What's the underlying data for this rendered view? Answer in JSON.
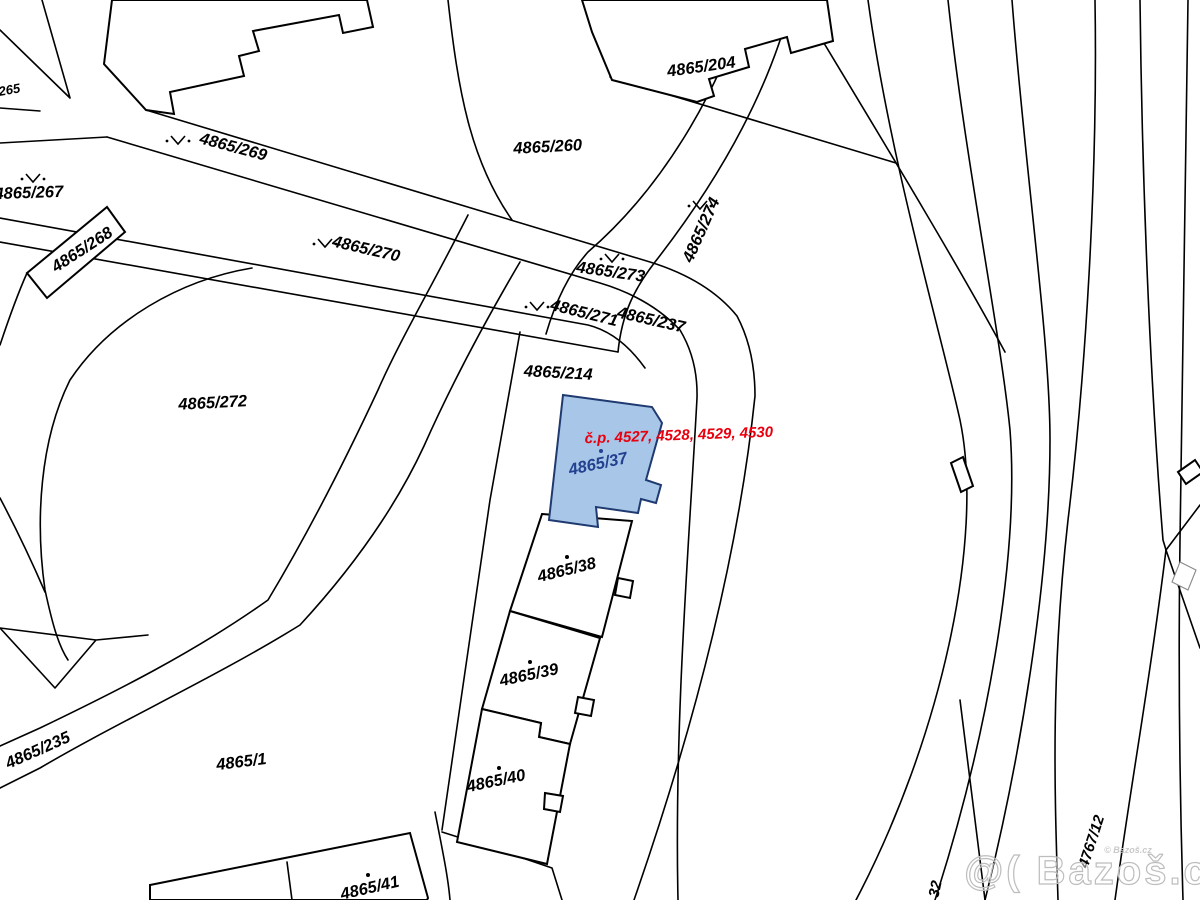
{
  "map": {
    "title": "cadastral-map-detail",
    "background_color": "#ffffff",
    "line_color": "#000000",
    "highlight": {
      "parcel": "4865/37",
      "fill": "#a7c6e8",
      "stroke": "#1f3a70",
      "label_color": "#23418f",
      "house_numbers_label": "č.p. 4527, 4528, 4529, 4530",
      "house_numbers_color": "#e8000f"
    },
    "watermark": {
      "text": "@( Bazoš.cz",
      "small_text": "© Bazoš.cz",
      "color": "#bdbdbd"
    },
    "labels": [
      {
        "text": "4865/265",
        "x": -6,
        "y": 97,
        "rot": -10,
        "size": 13
      },
      {
        "text": "4865/267",
        "x": 29,
        "y": 198,
        "rot": -2
      },
      {
        "text": "4865/268",
        "x": 85,
        "y": 254,
        "rot": -33
      },
      {
        "text": "4865/269",
        "x": 232,
        "y": 152,
        "rot": 15
      },
      {
        "text": "4865/270",
        "x": 365,
        "y": 254,
        "rot": 13
      },
      {
        "text": "4865/271",
        "x": 583,
        "y": 318,
        "rot": 14
      },
      {
        "text": "4865/237",
        "x": 650,
        "y": 325,
        "rot": 13
      },
      {
        "text": "4865/273",
        "x": 610,
        "y": 277,
        "rot": 8
      },
      {
        "text": "4865/274",
        "x": 706,
        "y": 232,
        "rot": -66
      },
      {
        "text": "4865/260",
        "x": 548,
        "y": 152,
        "rot": -3
      },
      {
        "text": "4865/204",
        "x": 702,
        "y": 72,
        "rot": -8
      },
      {
        "text": "4865/214",
        "x": 558,
        "y": 378,
        "rot": 3
      },
      {
        "text": "4865/272",
        "x": 213,
        "y": 408,
        "rot": -3
      },
      {
        "text": "4865/235",
        "x": 40,
        "y": 755,
        "rot": -24
      },
      {
        "text": "4865/1",
        "x": 242,
        "y": 767,
        "rot": -7
      },
      {
        "text": "4865/41",
        "x": 371,
        "y": 893,
        "rot": -13
      },
      {
        "text": "4865/40",
        "x": 497,
        "y": 786,
        "rot": -12
      },
      {
        "text": "4865/39",
        "x": 530,
        "y": 680,
        "rot": -12
      },
      {
        "text": "4865/38",
        "x": 568,
        "y": 575,
        "rot": -14
      },
      {
        "text": "4865/37",
        "x": 599,
        "y": 469,
        "rot": -12,
        "fill": "#23418f"
      },
      {
        "text": "č.p. 4527, 4528, 4529, 4530",
        "x": 679,
        "y": 440,
        "rot": -2,
        "fill": "#e8000f",
        "size": 15
      },
      {
        "text": "4767/12",
        "x": 1096,
        "y": 843,
        "rot": -72,
        "size": 15
      },
      {
        "text": "32",
        "x": 940,
        "y": 890,
        "rot": -78,
        "size": 15
      },
      {
        "text": "@( Bazoš.cz",
        "x": 1098,
        "y": 884,
        "rot": 0,
        "size": 40,
        "cls": "watermark"
      },
      {
        "text": "© Bazoš.cz",
        "x": 1128,
        "y": 853,
        "rot": 0,
        "size": 9,
        "fill": "#c9c9c9"
      }
    ],
    "v_symbols": [
      {
        "x": 33,
        "y": 178
      },
      {
        "x": 178,
        "y": 140
      },
      {
        "x": 325,
        "y": 243
      },
      {
        "x": 537,
        "y": 306
      },
      {
        "x": 612,
        "y": 258
      },
      {
        "x": 700,
        "y": 205
      }
    ],
    "dots": [
      {
        "x": 601,
        "y": 451,
        "color": "#23418f"
      },
      {
        "x": 567,
        "y": 557,
        "color": "#000000"
      },
      {
        "x": 530,
        "y": 662,
        "color": "#000000"
      },
      {
        "x": 499,
        "y": 768,
        "color": "#000000"
      },
      {
        "x": 368,
        "y": 875,
        "color": "#000000"
      }
    ]
  }
}
